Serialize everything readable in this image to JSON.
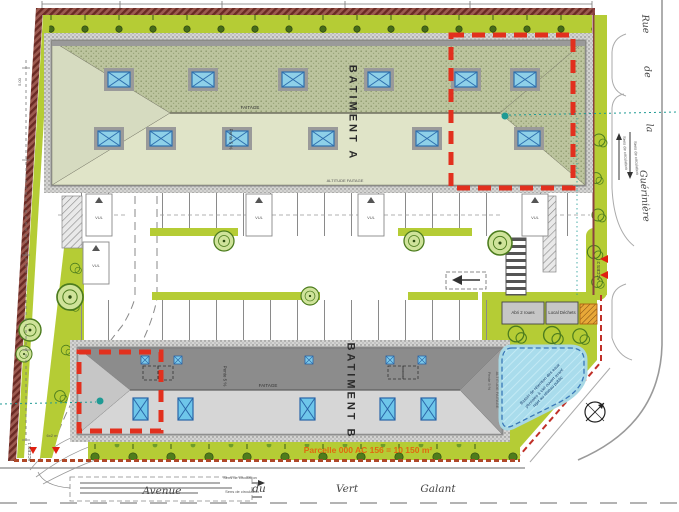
{
  "plan": {
    "building_a": {
      "name": "BATIMENT A",
      "ridge_label": "FAITAGE",
      "slope_label": "Pente 5 %",
      "altitude_label": "ALTITUDE FAITAGE"
    },
    "building_b": {
      "name": "BATIMENT B",
      "ridge_label": "FAITAGE",
      "slope_label": "Pente 5 %",
      "altitude_label": "ALTITUDE FAITAGE"
    },
    "parcel_label": "Parcelle 000 AC 156 = 10 150 m²",
    "access_1": "ACCES 1",
    "access_2": "ACCES 2",
    "gate_label": "6x2 m",
    "stall_label": "VUL",
    "bike_shelter_label": "Abri 2 roues",
    "waste_room_label": "Local Déchets",
    "basin_label": "Bassin de rétention des eaux pluviales à ciel ouvert avant rejet au réseau public",
    "dimension_label": "5.00"
  },
  "streets": {
    "avenue_words": [
      "Avenue",
      "du",
      "Vert",
      "Galant"
    ],
    "rue_words": [
      "Rue",
      "de",
      "la",
      "Guérinière"
    ],
    "direction_label": "Sens de circulation"
  },
  "colors": {
    "landscape_green": "#b5cc35",
    "roof_a_dark": "#bcc49e",
    "roof_a_light": "#e0e4c8",
    "roof_b_dark": "#8c8c8c",
    "roof_b_light": "#d6d6d6",
    "skylight_blue": "#8ed0e8",
    "boundary_red": "#e2301e",
    "parcel_orange": "#e06a10",
    "survey_teal": "#1f9a94",
    "basin_blue": "#a8d8e8"
  }
}
